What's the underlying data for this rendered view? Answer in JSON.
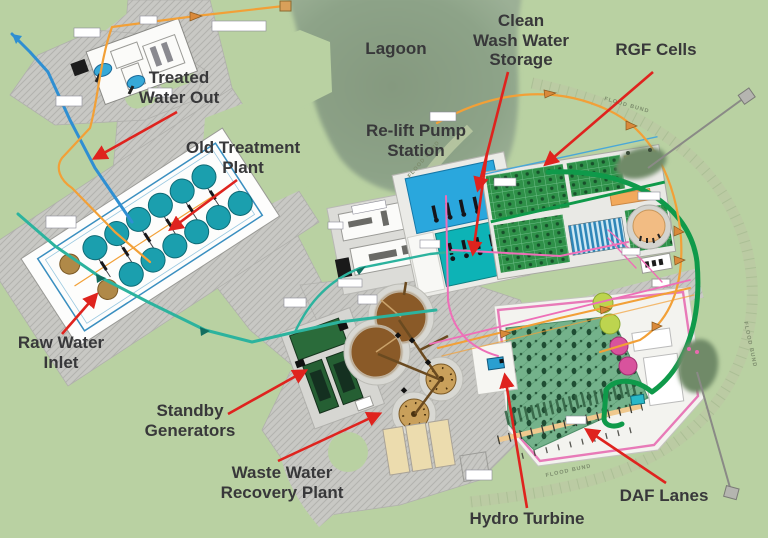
{
  "callouts": {
    "treated_water_out": "Treated\nWater Out",
    "old_treatment_plant": "Old Treatment\nPlant",
    "lagoon": "Lagoon",
    "clean_wash_water_storage": "Clean\nWash Water\nStorage",
    "rgf_cells": "RGF Cells",
    "re_lift_pump_station": "Re-lift Pump\nStation",
    "raw_water_inlet": "Raw Water\nInlet",
    "standby_generators": "Standby\nGenerators",
    "waste_water_recovery_plant": "Waste Water\nRecovery Plant",
    "hydro_turbine": "Hydro Turbine",
    "daf_lanes": "DAF Lanes"
  },
  "map_texts": {
    "flood_bund": "FLOOD BUND"
  },
  "colors": {
    "label_text": "#38383a",
    "arrow_red": "#df231e",
    "grass": "#b9d1a2",
    "lagoon": "#879c82",
    "road_grey": "#c8c8c4",
    "raw_water_pipe_teal": "#2cb39e",
    "treated_water_pipe_blue": "#2f8fd2",
    "wash_water_pipe_orange": "#f2a037",
    "sludge_pipe_green": "#0f9a4a",
    "recovery_pipe_pink": "#ee6fb8",
    "wash_water_storage_blue": "#2aa7dd",
    "relift_station_teal": "#0db3b6",
    "rgf_cell_green": "#2f9149",
    "daf_lane_green": "#74b28b",
    "generator_green": "#2a6b3a",
    "sludge_tank_brown": "#8a5a28",
    "thickener_tan": "#c9a05b",
    "clarifier_teal": "#1b9fae"
  }
}
